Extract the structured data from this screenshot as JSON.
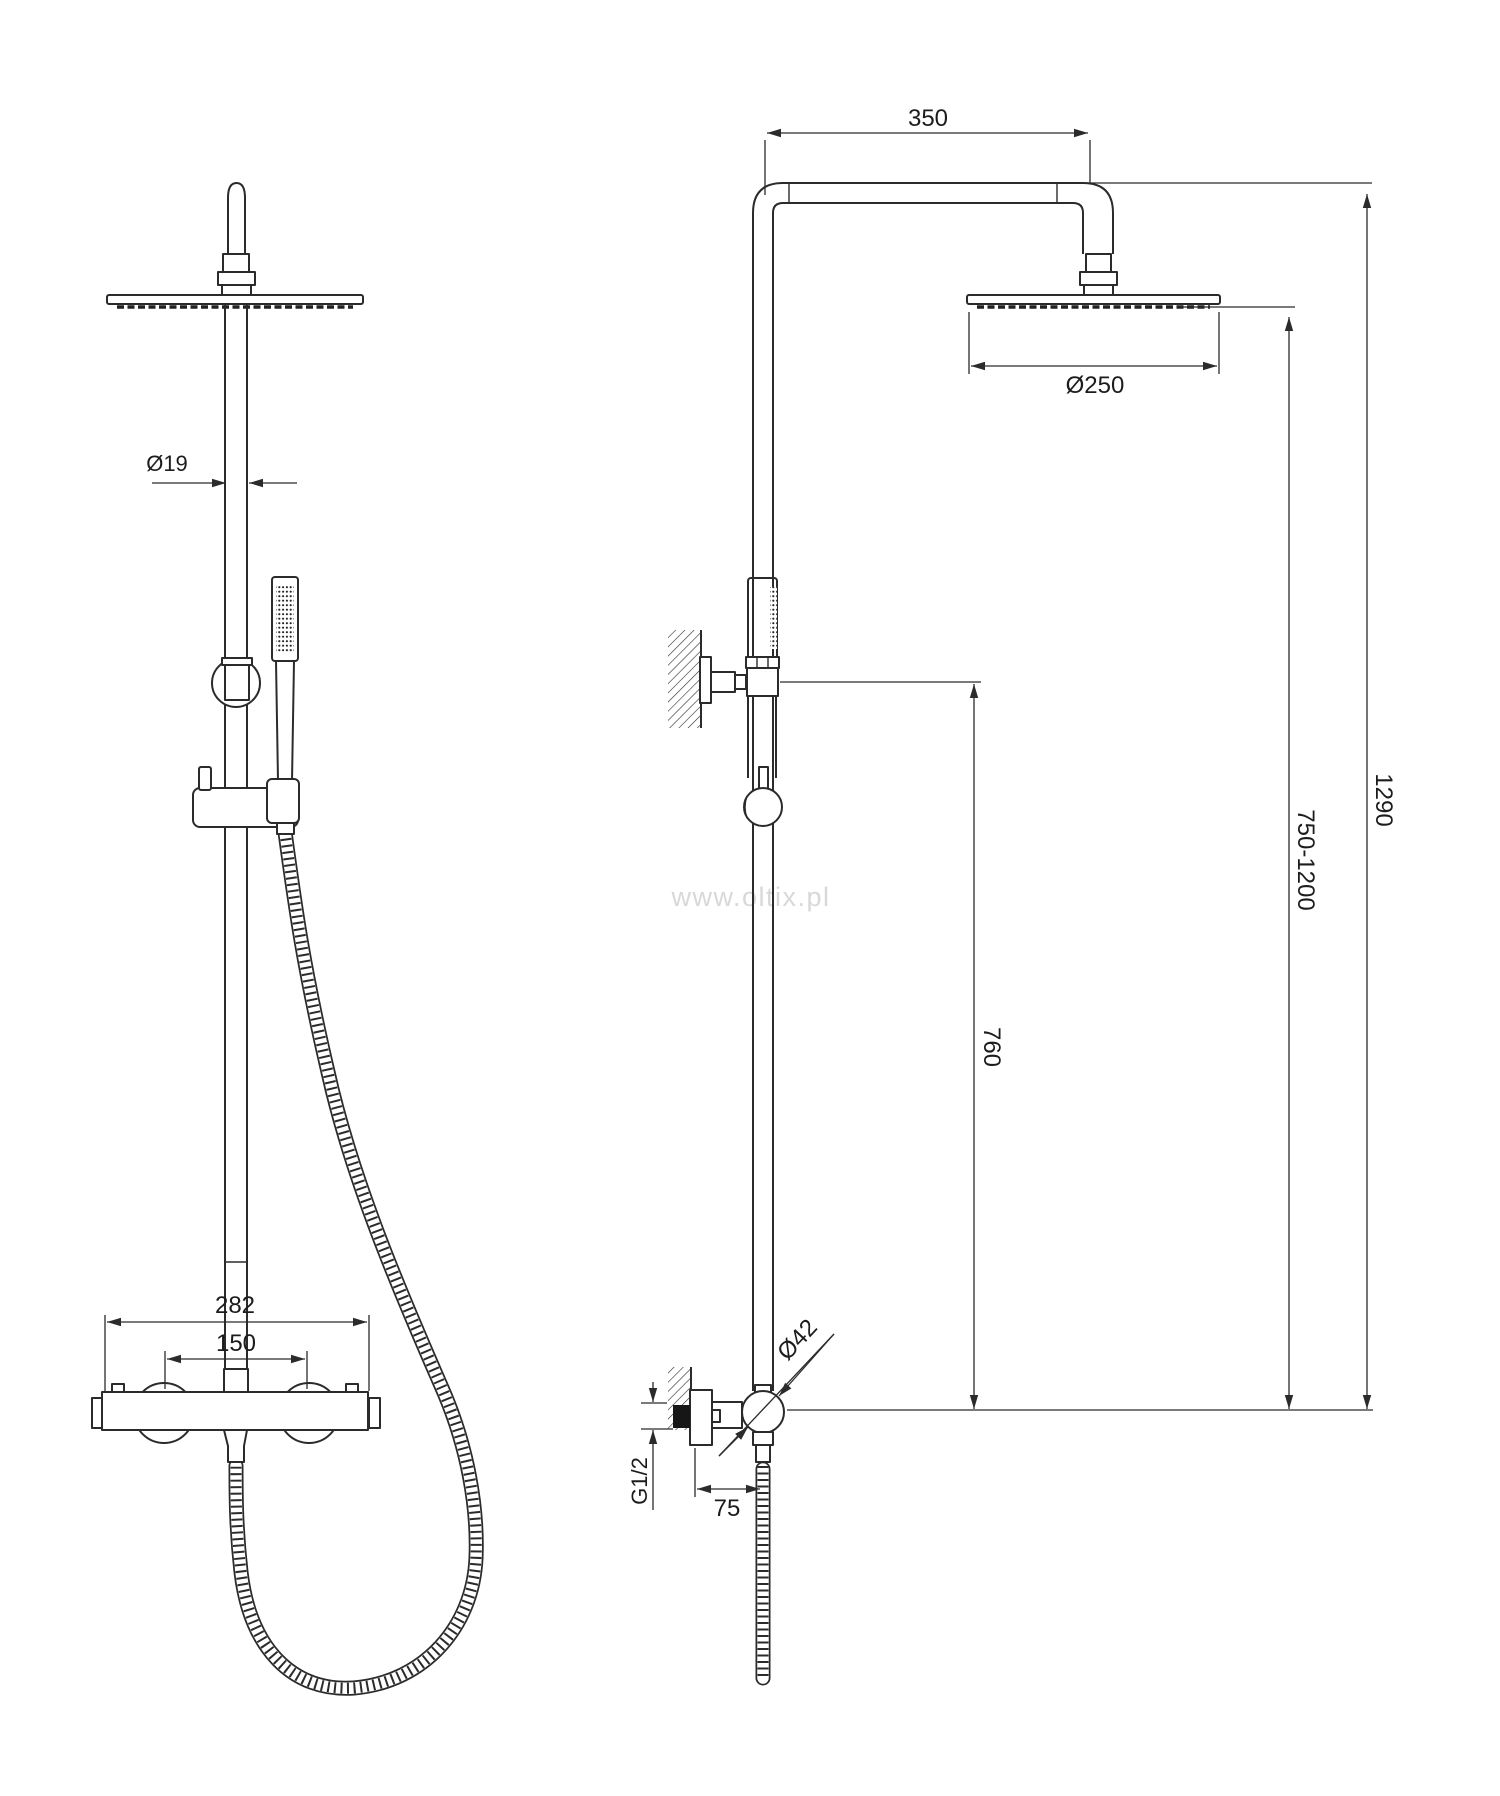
{
  "drawing": {
    "watermark": "www.oltix.pl",
    "views": {
      "front": "front view",
      "side": "side view"
    }
  },
  "dimensions": {
    "arm_reach": "350",
    "head_diameter": "Ø250",
    "pipe_diameter": "Ø19",
    "total_height": "1290",
    "riser_height_range": "750-1200",
    "bracket_height": "760",
    "mixer_width": "282",
    "inlet_spacing": "150",
    "elbow_diameter": "Ø42",
    "thread": "G1/2",
    "wall_offset": "75"
  },
  "colors": {
    "line": "#2b2b2b",
    "watermark": "#d8d8d8",
    "background": "#ffffff"
  }
}
